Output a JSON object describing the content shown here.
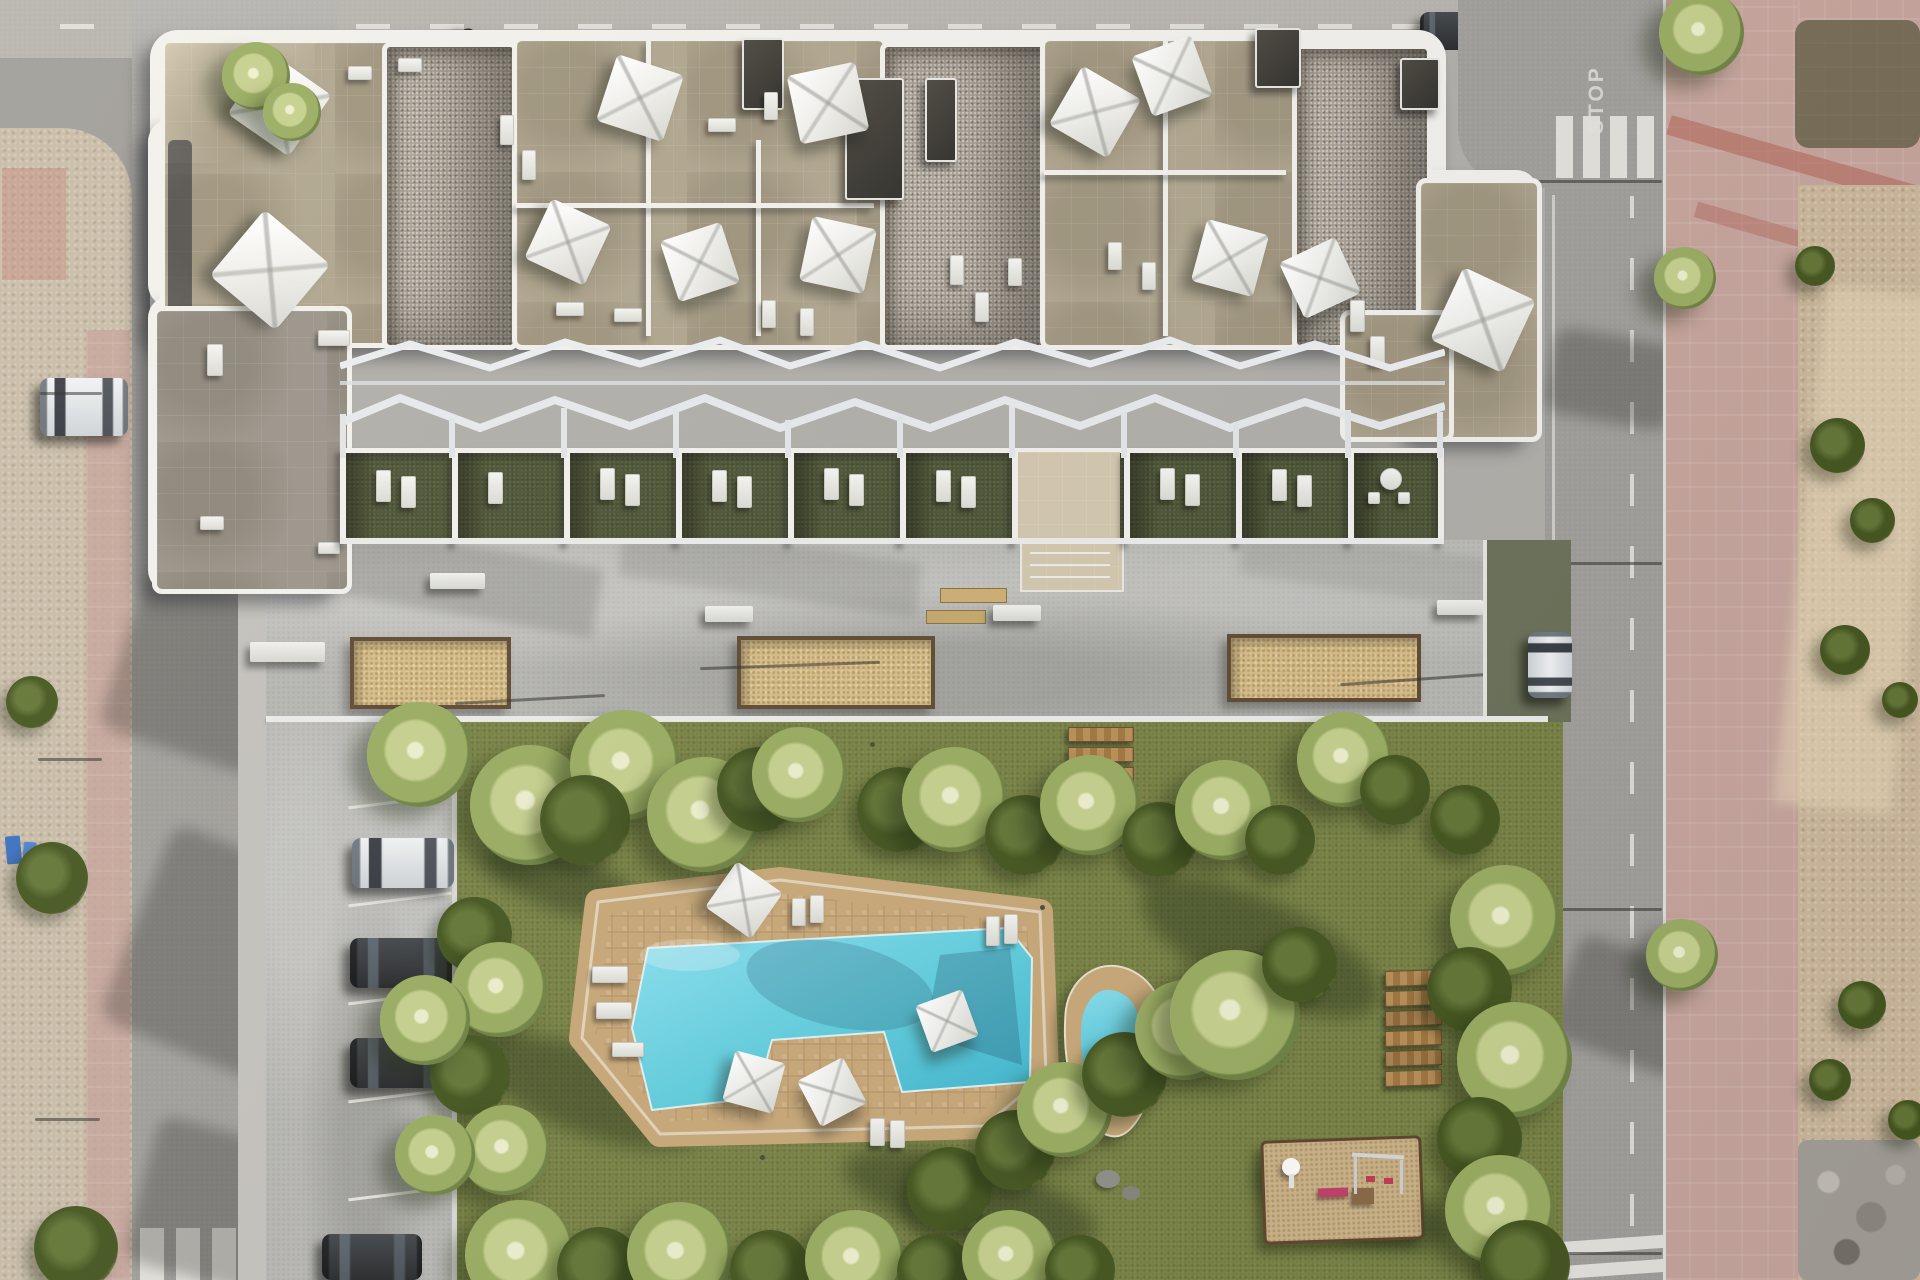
{
  "scene": {
    "type": "aerial-3d-architectural-render",
    "subject": "Top-down view of a modern apartment complex with rooftop terraces and white sail umbrellas, ground-floor private gardens under a white pergola lattice, a concrete promenade with sand planters and benches, a large communal lawn with a free-form swimming pool and a small secondary pool, wooden step path, wooden sun loungers, a children's playground, resident parking with three cars, bordered by asphalt streets, pink sidewalks and undeveloped dirt lots"
  },
  "road_markings": {
    "stop_text": "STOP"
  },
  "colors": {
    "asphalt": "#a09e9a",
    "asphaltLight": "#b6b3ae",
    "dirtLeft": "#c9bda9",
    "dirtRight": "#ccb89b",
    "sidewalkPink": "#c7a59c",
    "plaza": "#b8b8b4",
    "stone": "#b0a68f",
    "stoneLight": "#d3c8ae",
    "gravel": "#a8a093",
    "parapet": "#f3f2ee",
    "grass": "#75803f",
    "gardenGrass": "#4b5232",
    "poolShallow": "#8ce2f2",
    "poolDeep": "#3eb5cf",
    "deckTan": "#c9a979",
    "planterSand": "#d9be85",
    "planterEdge": "#5f4a33",
    "wood": "#ab8050",
    "white": "#f6f6f4"
  },
  "inventory": {
    "rooftop_umbrellas": 12,
    "pool_umbrellas": 4,
    "parked_cars": 4,
    "street_cars": 2,
    "driveway_car": 1,
    "pools": 2,
    "sand_planters": 3,
    "benches": 5,
    "wooden_steps": 6,
    "wooden_sun_loungers": 6,
    "playgrounds": 1,
    "garden_units": 9
  }
}
